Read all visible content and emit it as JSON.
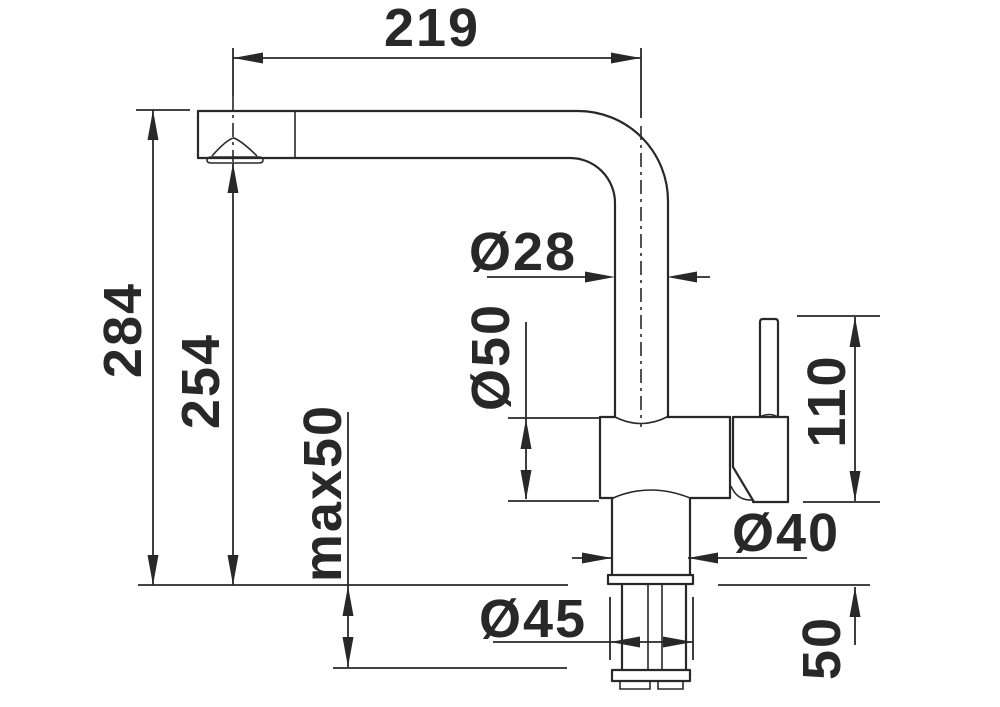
{
  "drawing": {
    "title": "Faucet dimensional drawing (side elevation)",
    "background": "#ffffff",
    "line_color": "#282828",
    "dimensions": {
      "spout_reach": "219",
      "overall_height": "284",
      "outlet_height": "254",
      "max_mounting_thickness": "max50",
      "spout_tube_diameter": "Ø28",
      "body_diameter": "Ø50",
      "lever_height": "110",
      "base_diameter": "Ø40",
      "drill_hole_diameter": "Ø45",
      "under_counter_length": "50"
    }
  }
}
